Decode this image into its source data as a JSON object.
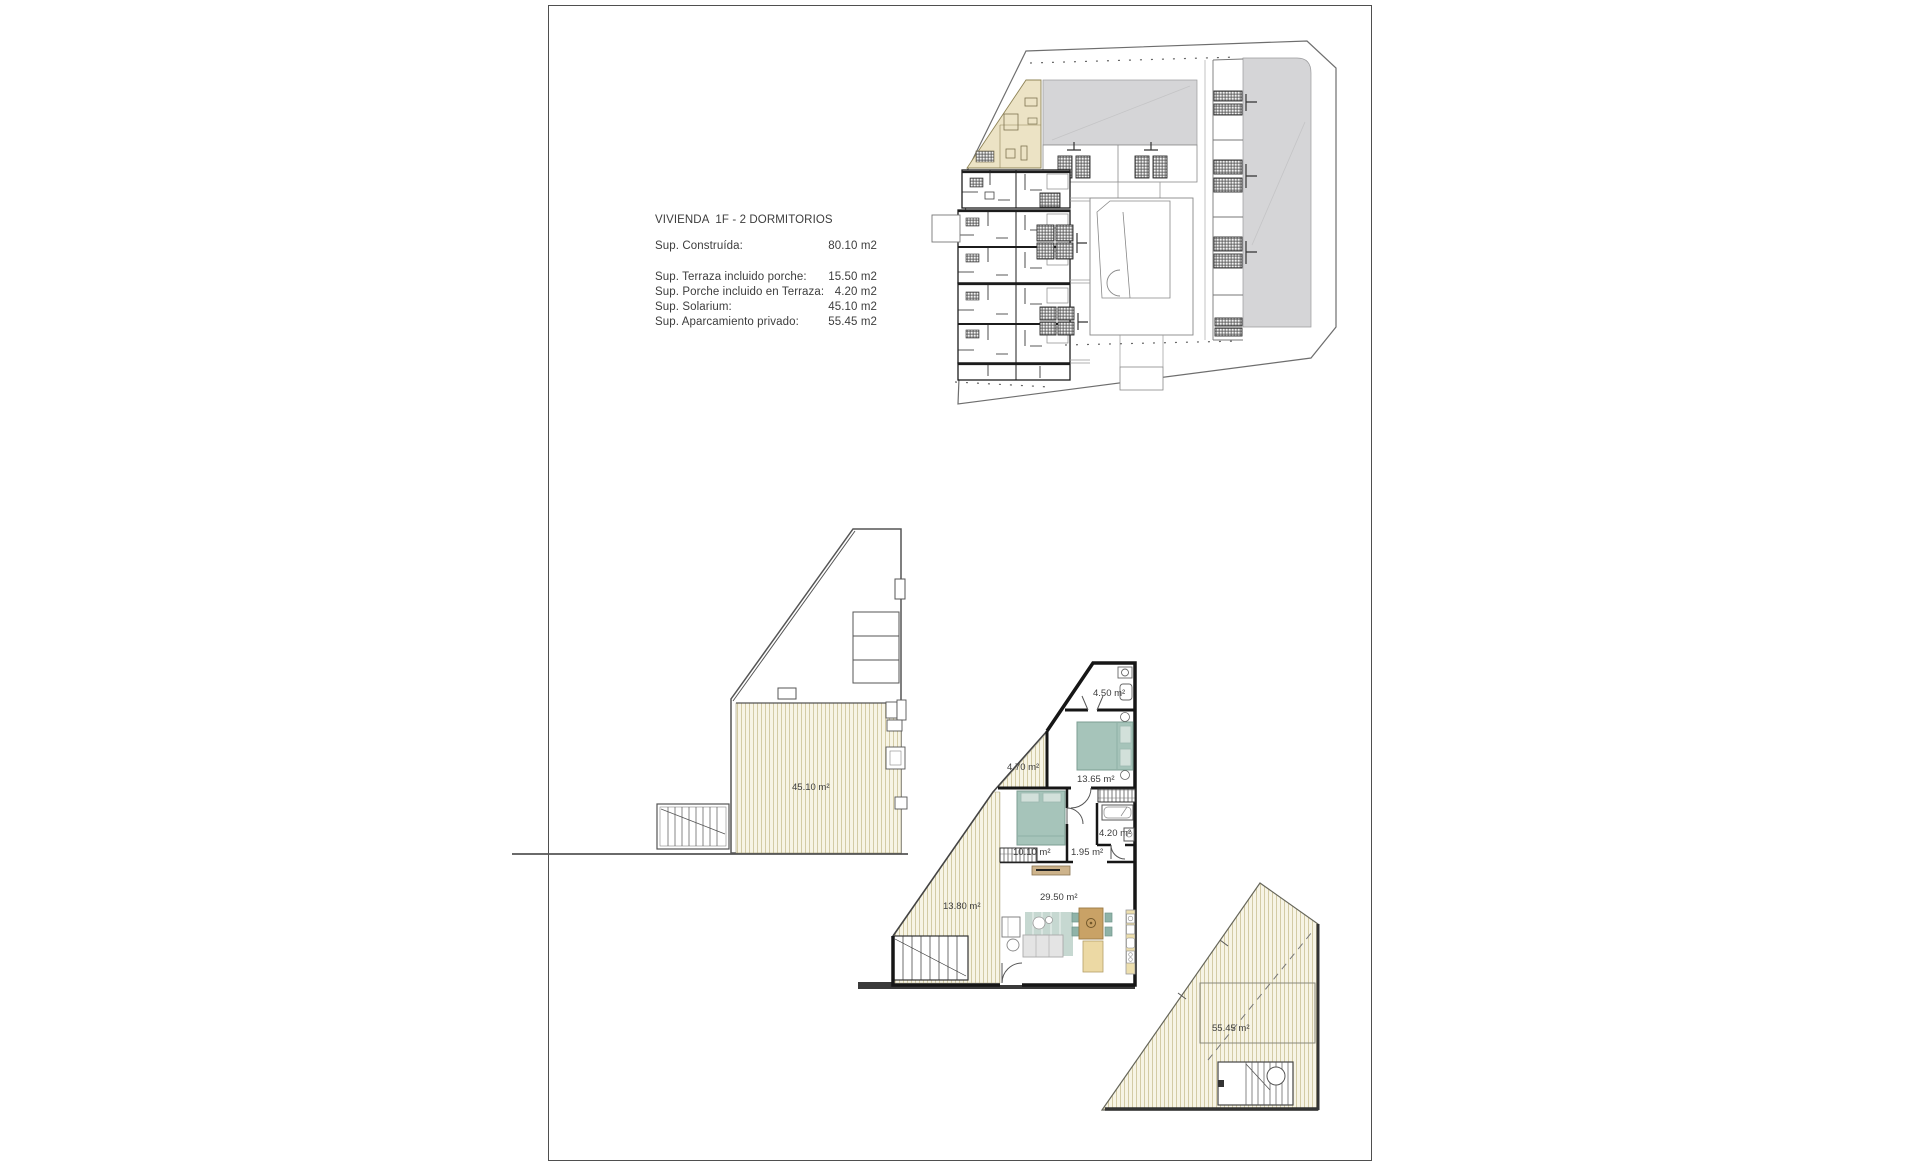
{
  "sheet": {
    "border_color": "#4f4f4f",
    "background": "#ffffff"
  },
  "spec_block": {
    "title": "VIVIENDA  1F - 2 DORMITORIOS",
    "rows": [
      {
        "label": "Sup. Construída:",
        "value": "80.10 m2"
      },
      {
        "label": "Sup. Terraza incluido porche:",
        "value": "15.50 m2"
      },
      {
        "label": "Sup. Porche incluido en Terraza:",
        "value": "4.20 m2"
      },
      {
        "label": "Sup. Solarium:",
        "value": "45.10 m2"
      },
      {
        "label": "Sup. Aparcamiento privado:",
        "value": "55.45 m2"
      }
    ]
  },
  "site_plan": {
    "highlight_color": "#ece3c5",
    "roof_color": "#d5d5d7"
  },
  "solarium_plan": {
    "area_label": "45.10 m²"
  },
  "floor_plan": {
    "room_labels": {
      "bathroom_top": "4.50 m²",
      "bedroom_main": "13.65 m²",
      "terrace_small": "4.70 m²",
      "bedroom_second": "10.10 m²",
      "bathroom_hall": "4.20 m²",
      "hall": "1.95 m²",
      "living_kitchen": "29.50 m²",
      "terrace_main": "13.80 m²"
    }
  },
  "parking_plan": {
    "area_label": "55.45 m²"
  },
  "colors": {
    "deck_base": "#f7f4e5",
    "deck_stripe": "#d3cba5",
    "wall": "#161616",
    "bed_teal": "#a6c4ba",
    "table_wood": "#c9a266",
    "kitchen_beige": "#eddfae"
  }
}
